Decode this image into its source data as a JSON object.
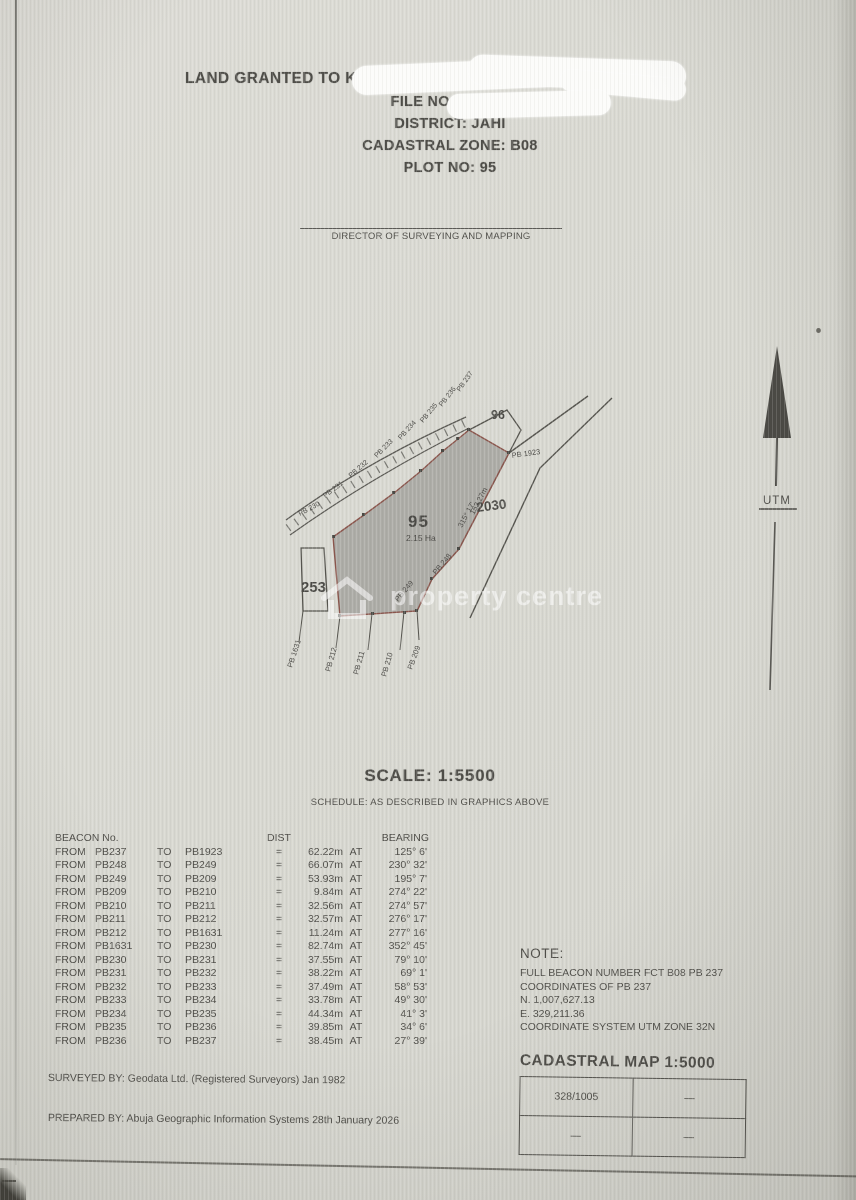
{
  "header": {
    "line1": "LAND GRANTED TO KII",
    "line2": "FILE NO: MISC 1",
    "line3": "DISTRICT: JAHI",
    "line4": "CADASTRAL ZONE: B08",
    "line5": "PLOT NO: 95"
  },
  "signature": {
    "label": "DIRECTOR OF SURVEYING AND MAPPING"
  },
  "map": {
    "plot_number": "95",
    "plot_area": "2.15 Ha",
    "adjacent_left": "253",
    "adjacent_top_right": "96",
    "adjacent_right": "2030",
    "corner_beacon": "PB 1923",
    "edge_dimension": "152.27m",
    "edge_bearing": "315° 17'",
    "arc_labels": [
      "PB 230",
      "PB 231",
      "PB 232",
      "PB 233",
      "PB 234",
      "PB 235",
      "PB 236",
      "PB 237"
    ],
    "bottom_labels": [
      "PB 1631",
      "PB 212",
      "PB 211",
      "PB 210",
      "PB 209"
    ],
    "side_labels": [
      "PB 248",
      "PB 249"
    ],
    "north_label": "UTM",
    "watermark_text": "property centre"
  },
  "scale": {
    "title": "SCALE: 1:5500",
    "subtitle": "SCHEDULE: AS DESCRIBED IN GRAPHICS ABOVE"
  },
  "schedule": {
    "header_beacon": "BEACON No.",
    "header_dist": "DIST",
    "header_bearing": "BEARING",
    "from_label": "FROM",
    "to_label": "TO",
    "eq": "=",
    "at": "AT",
    "rows": [
      {
        "from": "PB237",
        "to": "PB1923",
        "dist": "62.22m",
        "bearing": "125° 6'"
      },
      {
        "from": "PB248",
        "to": "PB249",
        "dist": "66.07m",
        "bearing": "230° 32'"
      },
      {
        "from": "PB249",
        "to": "PB209",
        "dist": "53.93m",
        "bearing": "195° 7'"
      },
      {
        "from": "PB209",
        "to": "PB210",
        "dist": "9.84m",
        "bearing": "274° 22'"
      },
      {
        "from": "PB210",
        "to": "PB211",
        "dist": "32.56m",
        "bearing": "274° 57'"
      },
      {
        "from": "PB211",
        "to": "PB212",
        "dist": "32.57m",
        "bearing": "276° 17'"
      },
      {
        "from": "PB212",
        "to": "PB1631",
        "dist": "11.24m",
        "bearing": "277° 16'"
      },
      {
        "from": "PB1631",
        "to": "PB230",
        "dist": "82.74m",
        "bearing": "352° 45'"
      },
      {
        "from": "PB230",
        "to": "PB231",
        "dist": "37.55m",
        "bearing": "79° 10'"
      },
      {
        "from": "PB231",
        "to": "PB232",
        "dist": "38.22m",
        "bearing": "69° 1'"
      },
      {
        "from": "PB232",
        "to": "PB233",
        "dist": "37.49m",
        "bearing": "58° 53'"
      },
      {
        "from": "PB233",
        "to": "PB234",
        "dist": "33.78m",
        "bearing": "49° 30'"
      },
      {
        "from": "PB234",
        "to": "PB235",
        "dist": "44.34m",
        "bearing": "41° 3'"
      },
      {
        "from": "PB235",
        "to": "PB236",
        "dist": "39.85m",
        "bearing": "34° 6'"
      },
      {
        "from": "PB236",
        "to": "PB237",
        "dist": "38.45m",
        "bearing": "27° 39'"
      }
    ]
  },
  "note": {
    "title": "NOTE:",
    "lines": [
      "FULL BEACON NUMBER FCT B08 PB 237",
      "COORDINATES OF PB 237",
      "N. 1,007,627.13",
      "E. 329,211.36",
      "COORDINATE SYSTEM UTM ZONE 32N"
    ]
  },
  "cadastral_map": {
    "title": "CADASTRAL MAP 1:5000",
    "cells": [
      [
        "328/1005",
        "—"
      ],
      [
        "—",
        "—"
      ]
    ]
  },
  "footer": {
    "surveyed_by": "SURVEYED BY: Geodata Ltd. (Registered Surveyors)  Jan 1982",
    "prepared_by": "PREPARED BY: Abuja Geographic Information Systems  28th January 2026"
  },
  "colors": {
    "paper": "#d9d9d2",
    "ink": "#4e4d48",
    "parcel_fill": "#a6a5a1",
    "parcel_outline": "#8a554c",
    "redaction": "#fcfcfa"
  }
}
